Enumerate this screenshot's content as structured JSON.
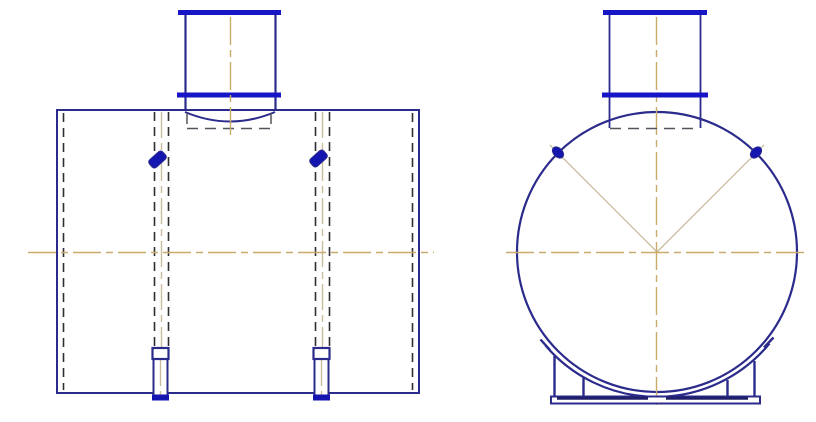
{
  "drawing": {
    "kind": "engineering-drawing",
    "views": [
      {
        "id": "side-view",
        "parts": [
          "tank-shell",
          "top-nozzle-with-flanges",
          "hidden-pipe-lines",
          "lifting-lugs",
          "bottom-legs",
          "centerlines"
        ]
      },
      {
        "id": "end-view",
        "parts": [
          "tank-shell-circle",
          "top-nozzle-with-flanges",
          "lifting-lugs",
          "saddle-support",
          "centerlines"
        ]
      }
    ]
  },
  "colors": {
    "background": "#ffffff",
    "outline": "#2b2b8c",
    "outline_dark": "#20206a",
    "flange": "#1616c6",
    "lug_fill": "#1515b0",
    "hidden_line": "#2f2f33",
    "hidden_line_gray": "#54545c",
    "centerline": "#c9ac6b",
    "centerline_soft": "#c8bd9c"
  }
}
